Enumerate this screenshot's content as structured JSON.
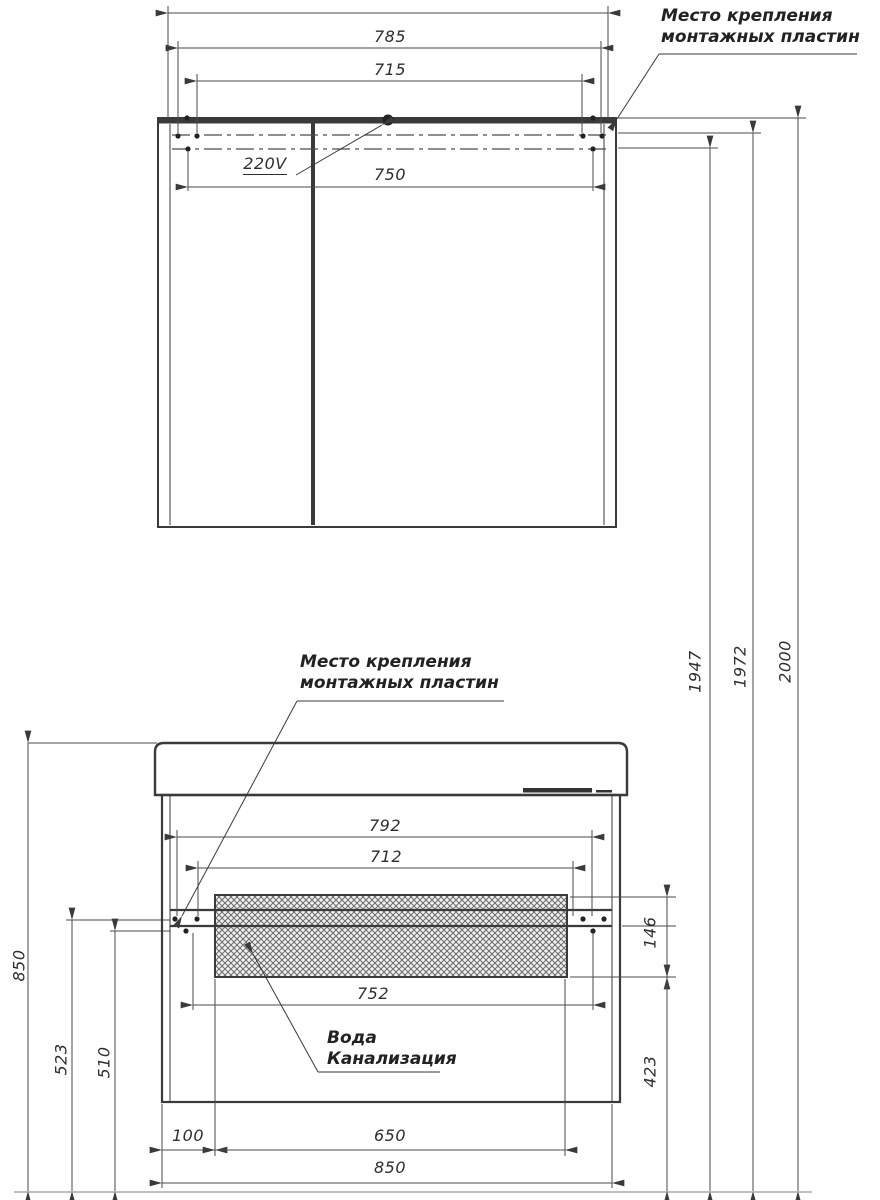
{
  "colors": {
    "object_line": "#3a3a3a",
    "thin_line": "#4a4a4a",
    "text": "#2e2e2e",
    "background": "#ffffff"
  },
  "top_view": {
    "dim_785": "785",
    "dim_715": "715",
    "dim_750": "750",
    "power_label": "220V",
    "mount_note_line1": "Место крепления",
    "mount_note_line2": "монтажных пластин"
  },
  "front_view": {
    "mount_note_line1": "Место крепления",
    "mount_note_line2": "монтажных пластин",
    "dim_792": "792",
    "dim_712": "712",
    "dim_752": "752",
    "dim_146": "146",
    "dim_423": "423",
    "dim_100": "100",
    "dim_650": "650",
    "dim_850": "850",
    "water_note_line1": "Вода",
    "water_note_line2": "Канализация"
  },
  "heights": {
    "dim_850": "850",
    "dim_523": "523",
    "dim_510": "510",
    "dim_1947": "1947",
    "dim_1972": "1972",
    "dim_2000": "2000"
  }
}
